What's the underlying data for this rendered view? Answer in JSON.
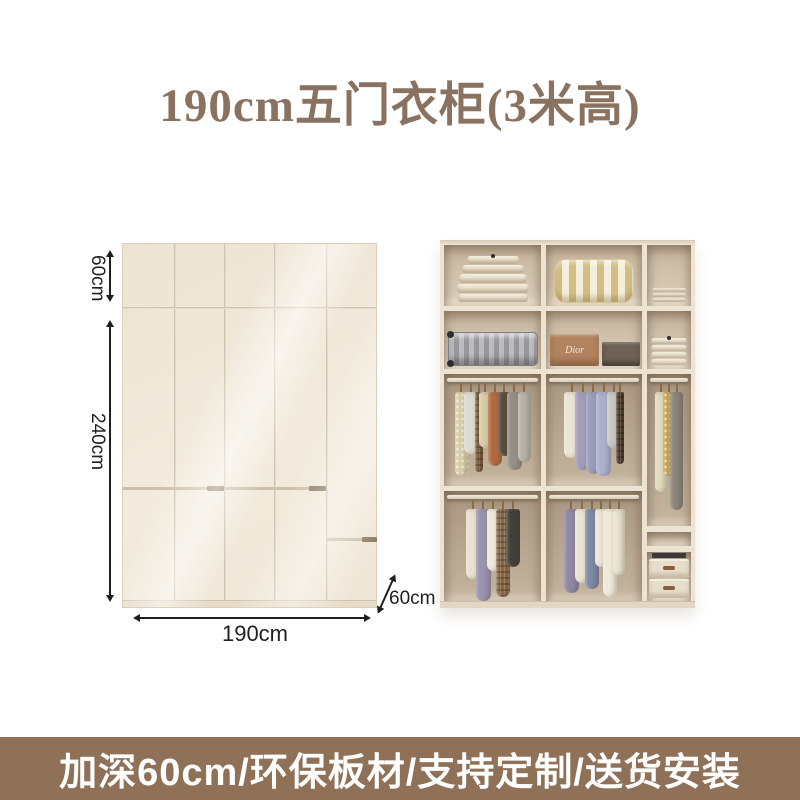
{
  "title": {
    "text": "190cm五门衣柜(3米高)"
  },
  "diagram": {
    "door_count": 5,
    "labels": {
      "top_height": "60cm",
      "main_height": "240cm",
      "width": "190cm",
      "depth": "60cm"
    }
  },
  "photo": {
    "dior_label": "Dior",
    "shelf_items": {
      "r1c1": "folded-duvets",
      "r1c2": "striped-pillow",
      "r1c3": "folded-towels",
      "r2c1": "aluminum-suitcase",
      "r2c2": "gift-boxes",
      "r2c3": "folded-towels",
      "c3box": "storage-boxes"
    },
    "rails": [
      {
        "id": "r3c1",
        "items": [
          {
            "c": "#d9cda8",
            "w": 13,
            "h": 84,
            "pattern": "dots"
          },
          {
            "c": "#dddcd2",
            "w": 15,
            "h": 62
          },
          {
            "c": "#7c5c3c",
            "w": 8,
            "h": 80,
            "pattern": "plaid"
          },
          {
            "c": "#d8caa2",
            "w": 13,
            "h": 56
          },
          {
            "c": "#b26b3e",
            "w": 14,
            "h": 74
          },
          {
            "c": "#5a4c3e",
            "w": 13,
            "h": 64
          },
          {
            "c": "#949087",
            "w": 15,
            "h": 78
          },
          {
            "c": "#b7b3a8",
            "w": 13,
            "h": 70
          }
        ]
      },
      {
        "id": "r3c2",
        "items": [
          {
            "c": "#ece5d4",
            "w": 15,
            "h": 66
          },
          {
            "c": "#a39dbb",
            "w": 15,
            "h": 78
          },
          {
            "c": "#9a9cb9",
            "w": 14,
            "h": 82
          },
          {
            "c": "#abb0cb",
            "w": 15,
            "h": 84
          },
          {
            "c": "#c9c7c1",
            "w": 13,
            "h": 56
          },
          {
            "c": "#4e3b2b",
            "w": 8,
            "h": 72,
            "pattern": "plaid"
          }
        ]
      },
      {
        "id": "c3tall",
        "items": [
          {
            "c": "#e3dabe",
            "w": 12,
            "h": 100
          },
          {
            "c": "#c7a64a",
            "w": 11,
            "h": 84,
            "pattern": "dots"
          },
          {
            "c": "#8b857b",
            "w": 13,
            "h": 118
          }
        ]
      },
      {
        "id": "r4c1",
        "items": [
          {
            "c": "#e9e2d0",
            "w": 14,
            "h": 70
          },
          {
            "c": "#9a93ad",
            "w": 15,
            "h": 92
          },
          {
            "c": "#eee9da",
            "w": 13,
            "h": 62
          },
          {
            "c": "#8a6845",
            "w": 14,
            "h": 88,
            "pattern": "plaid"
          },
          {
            "c": "#44403a",
            "w": 14,
            "h": 58
          }
        ]
      },
      {
        "id": "r4c2",
        "items": [
          {
            "c": "#8e88a2",
            "w": 15,
            "h": 84
          },
          {
            "c": "#eae4d3",
            "w": 14,
            "h": 74
          },
          {
            "c": "#7e89a6",
            "w": 14,
            "h": 80
          },
          {
            "c": "#ece6d6",
            "w": 12,
            "h": 58
          },
          {
            "c": "#efe9da",
            "w": 14,
            "h": 88
          },
          {
            "c": "#e9e2cf",
            "w": 12,
            "h": 66
          }
        ]
      }
    ]
  },
  "banner": {
    "text": "加深60cm/环保板材/支持定制/送货安装"
  },
  "colors": {
    "title": "#8a7260",
    "dim": "#1f1f1f",
    "front-line": "#cfc2ae",
    "front-groove": "#cdc0aa",
    "front-notch": "#8e7e66",
    "front-plinth": "#e7dcc9",
    "frame": "#ece3d2",
    "cell-top": "#c6b59e",
    "cell-bottom": "#dccfba",
    "cell-dark-top": "#a99781",
    "cell-dark-bottom": "#c4b49e",
    "duvet": "#f4eedf",
    "stripe-a": "#d3bd85",
    "stripe-b": "#f4eedb",
    "towel": "#f2ecdd",
    "suitcase": "#98989b",
    "box-dior": "#b1835f",
    "box-dark": "#6e6156",
    "storage-box": "#e6ddcb",
    "rod": "#f3ecdf",
    "hook": "#8a6b45",
    "banner-bg": "#8e7157",
    "banner-text": "#ffffff"
  }
}
